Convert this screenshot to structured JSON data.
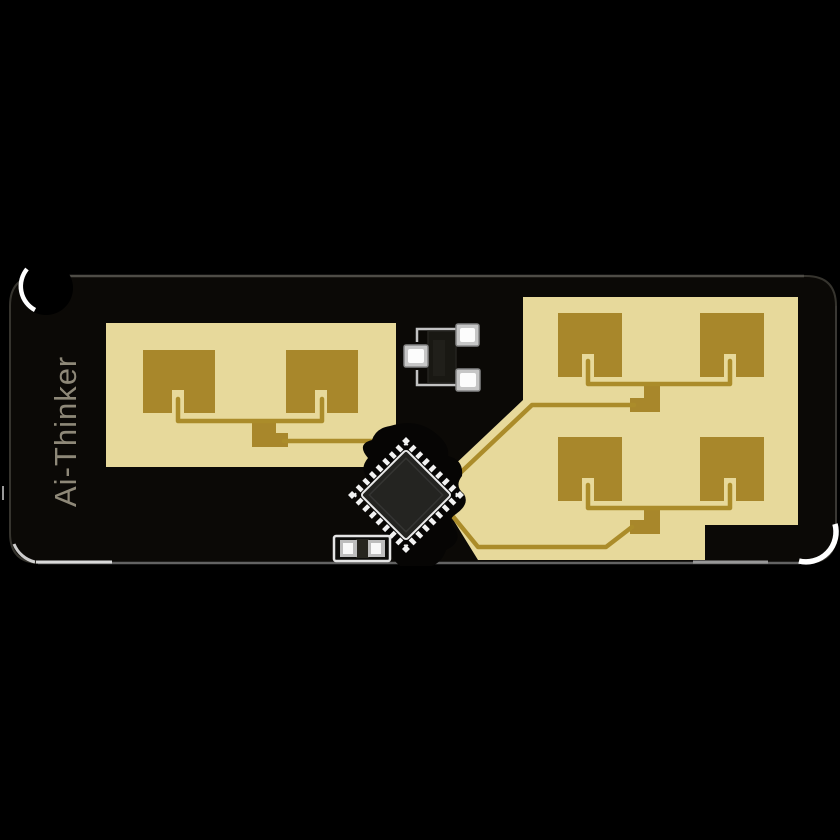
{
  "brand": {
    "label": "Ai-Thinker"
  },
  "colors": {
    "background": "#000000",
    "board": "#0b0906",
    "substrate": "#e7d99b",
    "patch": "#a8872b",
    "trace": "#ab8c2a",
    "brand_text": "#8e8878",
    "chip_body": "#242421",
    "silkscreen": "#c2c2c2",
    "edge_highlight": "#ffffff"
  },
  "components": {
    "chip": "qfn-chip-rotated-45",
    "three_pad_part": "sot23-package",
    "two_pad_part": "two-pad-smd",
    "antenna_patches_left": 2,
    "antenna_patches_right": 4
  }
}
